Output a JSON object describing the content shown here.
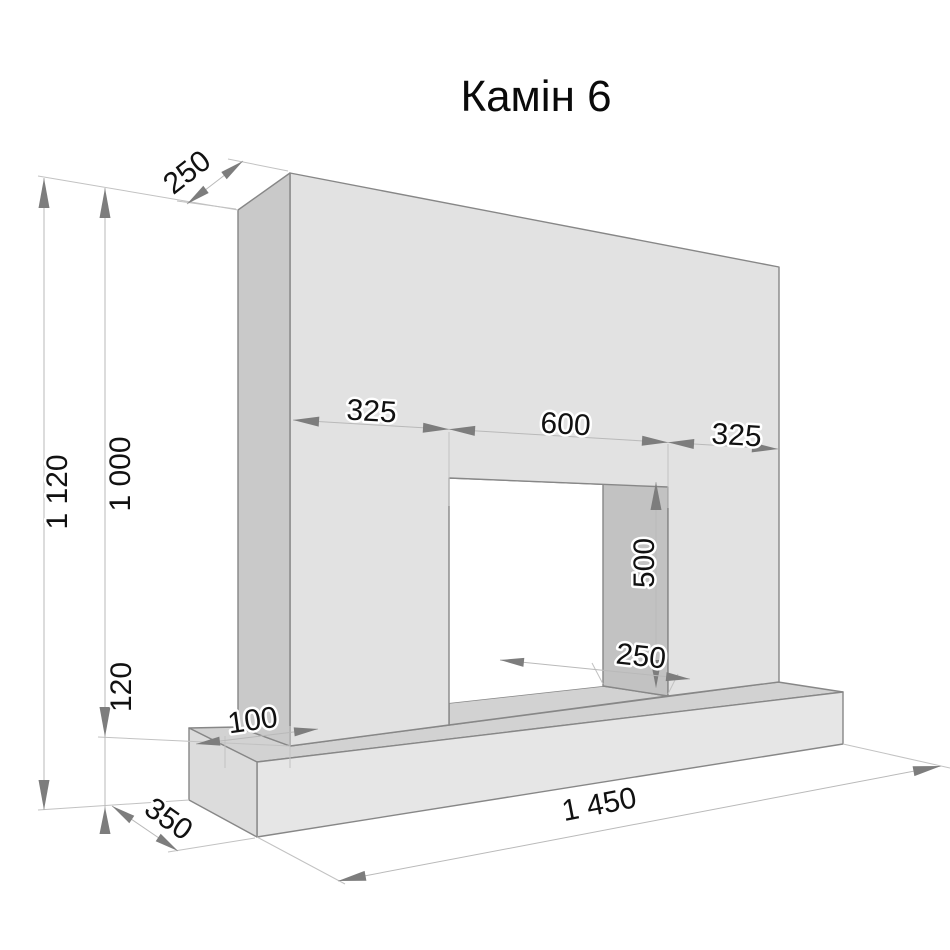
{
  "title": "Камін 6",
  "drawing": {
    "object": "fireplace-dimension-drawing",
    "units": "mm",
    "dimensions": {
      "overall_height": "1 120",
      "body_height": "1 000",
      "plinth_height": "120",
      "body_depth": "250",
      "left_pier_width": "325",
      "opening_width": "600",
      "right_pier_width": "325",
      "opening_height": "500",
      "opening_depth": "250",
      "plinth_margin": "100",
      "plinth_depth": "350",
      "plinth_width": "1 450"
    },
    "colors": {
      "background": "#ffffff",
      "front_face": "#e2e2e2",
      "left_face": "#c9c9c9",
      "opening_soffit": "#b2b2b2",
      "opening_inner_wall": "#c2c2c2",
      "plinth_top": "#d2d2d2",
      "plinth_front": "#e6e6e6",
      "plinth_end": "#dcdcdc",
      "edge_line": "#878787",
      "dimension_line": "#b9b9b9",
      "arrow": "#7d7d7d",
      "text": "#111111"
    }
  }
}
